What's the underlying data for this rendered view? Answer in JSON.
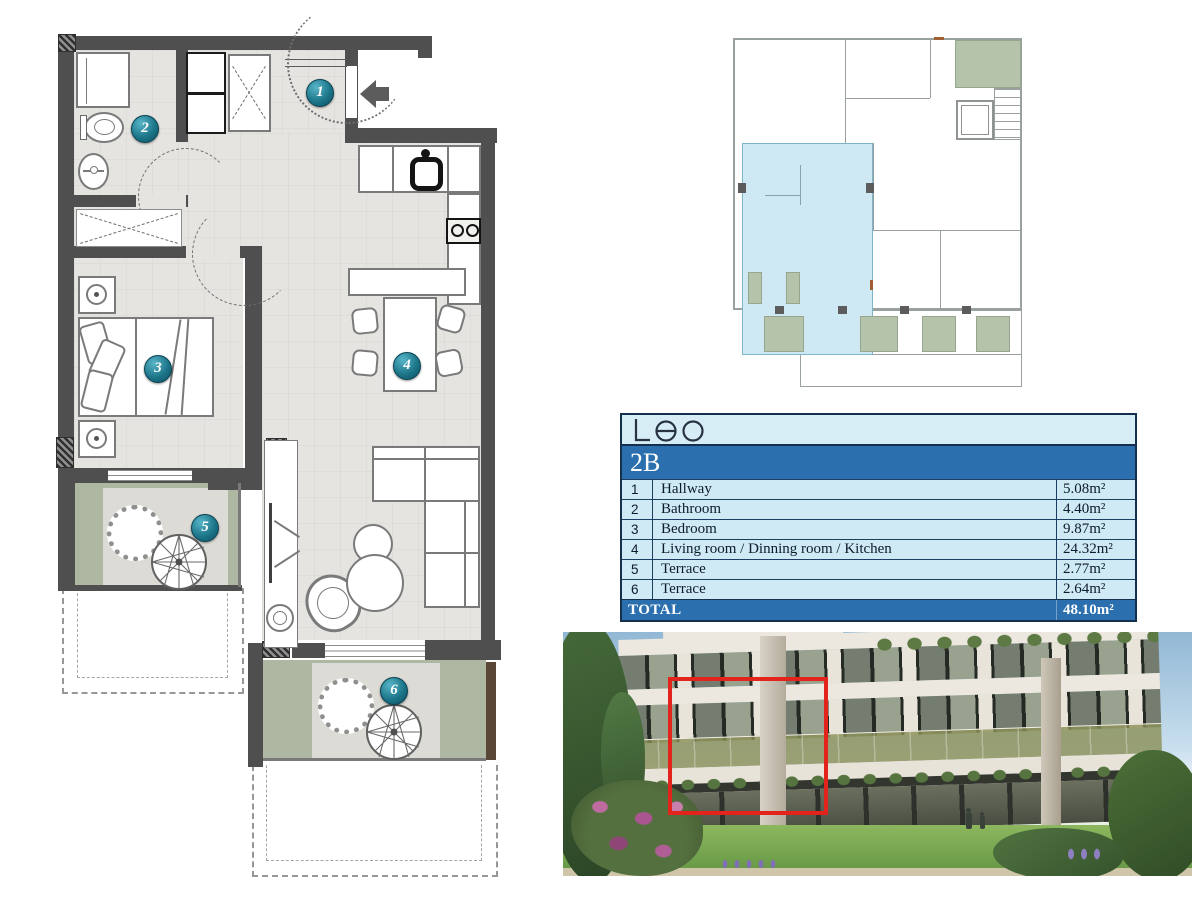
{
  "floor_plan": {
    "badges": [
      "1",
      "2",
      "3",
      "4",
      "5",
      "6"
    ]
  },
  "site_plan": {
    "description": "key plan with unit highlighted"
  },
  "table": {
    "logo_text": "Leo",
    "unit_label": "2B",
    "rows": [
      {
        "num": "1",
        "name": "Hallway",
        "area": "5.08m²"
      },
      {
        "num": "2",
        "name": "Bathroom",
        "area": "4.40m²"
      },
      {
        "num": "3",
        "name": "Bedroom",
        "area": "9.87m²"
      },
      {
        "num": "4",
        "name": "Living room / Dinning room / Kitchen",
        "area": "24.32m²"
      },
      {
        "num": "5",
        "name": "Terrace",
        "area": "2.77m²"
      },
      {
        "num": "6",
        "name": "Terrace",
        "area": "2.64m²"
      }
    ],
    "total": {
      "label": "TOTAL",
      "area": "48.10m²"
    }
  },
  "colors": {
    "accent_blue": "#2b6fae",
    "light_blue": "#cfe9f5",
    "badge_teal": "#16697e",
    "highlight_red": "#e3241d",
    "terrace_green": "#adb7a1",
    "wall_gray": "#4f4f4f",
    "site_unit_blue": "#cfe9f4"
  }
}
